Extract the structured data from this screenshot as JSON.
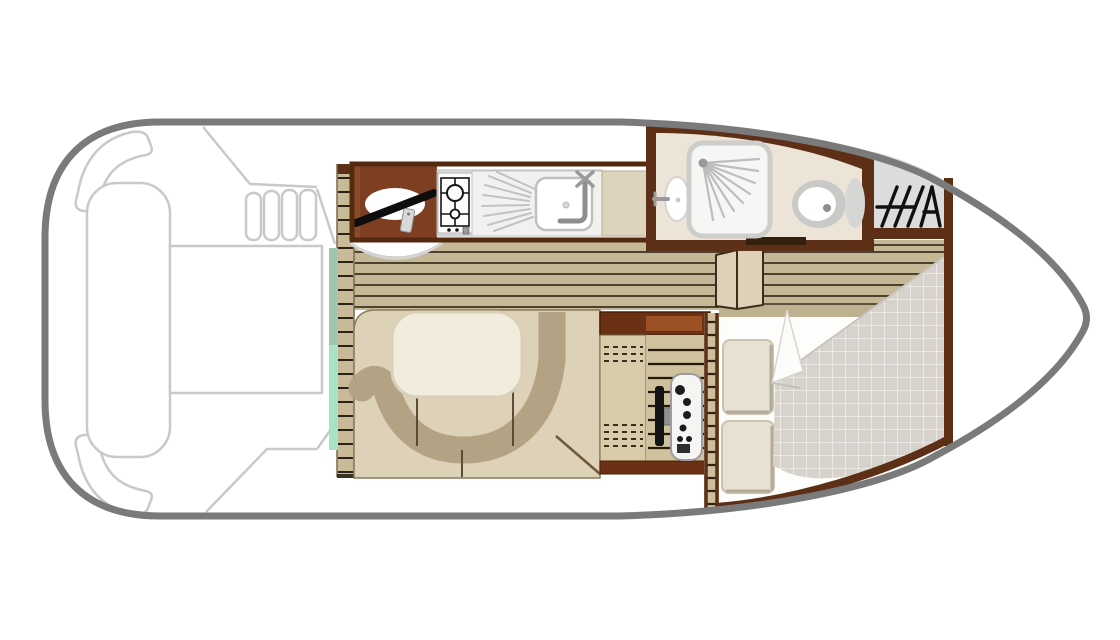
{
  "palette": {
    "background": "#ffffff",
    "hull_outline": "#7a7a7a",
    "deck_outline": "#c9c9c9",
    "wall_brown": "#5c2f16",
    "helm_brown": "#7d3e22",
    "cabinet_brown_dark": "#6b3115",
    "cabinet_brown_inner": "#9c5124",
    "wood_floor": "#c4b896",
    "wood_line": "#3a3122",
    "ladder_wood": "#c9ba97",
    "mint_door_top": "#9ec6b2",
    "mint_door_bottom": "#a9e2c4",
    "seat_beige": "#ddd2b8",
    "backrest_tan": "#b3a384",
    "table_cream": "#f2ecdd",
    "counter_gray": "#dadada",
    "appliance_white": "#fcfcfc",
    "bathroom_floor": "#ece4d6",
    "shower_white": "#f6f6f5",
    "blanket_gray": "#d7d3cc",
    "pillow_beige": "#e8e1d1",
    "bed_white": "#fdfdfc",
    "hatch_gray": "#dcdcdc",
    "tv_black": "#141414",
    "khaki_band": "#bdb190",
    "shelf_wood": "#d8cba9",
    "slat_wood": "#cfc19d"
  },
  "regions": [
    {
      "id": "stern-deck"
    },
    {
      "id": "saloon-galley"
    },
    {
      "id": "dinette"
    },
    {
      "id": "bathroom"
    },
    {
      "id": "bow-cabin"
    },
    {
      "id": "anchor-locker"
    },
    {
      "id": "bow-deck"
    }
  ]
}
